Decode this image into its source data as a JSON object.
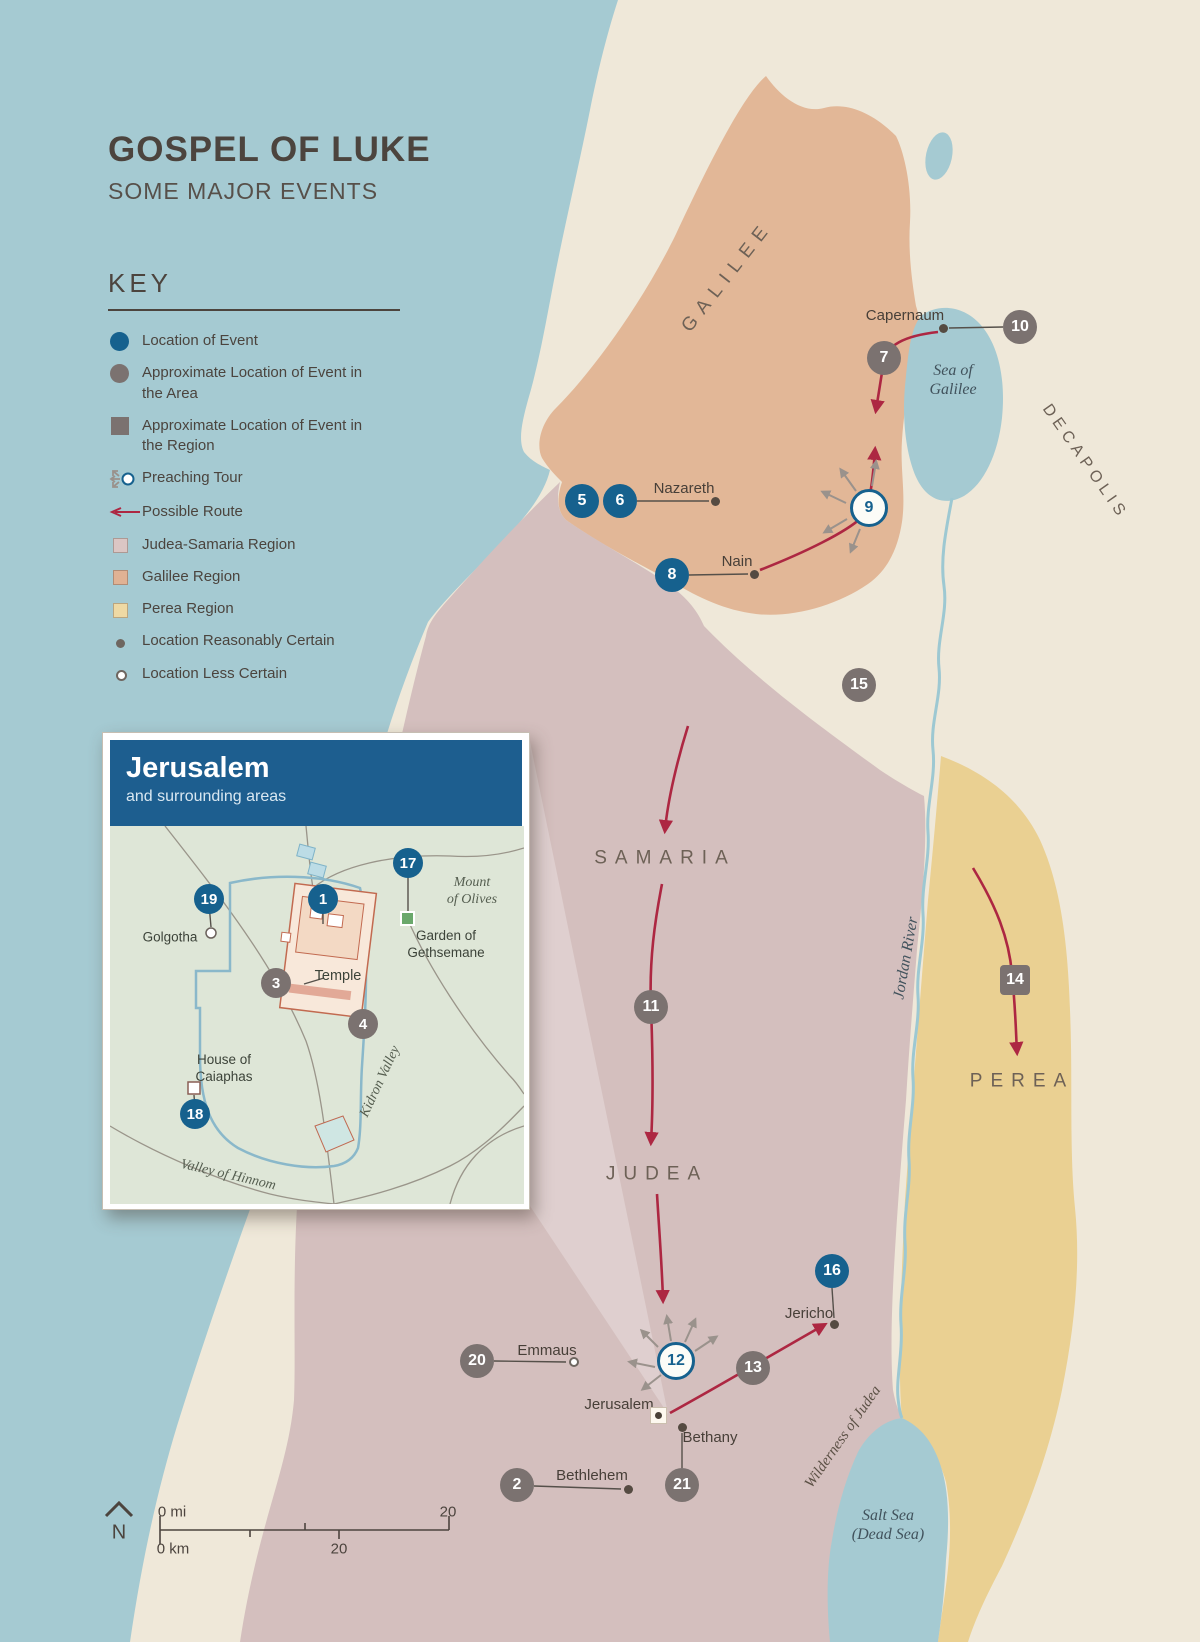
{
  "page": {
    "title": "GOSPEL OF LUKE",
    "subtitle": "SOME MAJOR EVENTS"
  },
  "key": {
    "heading": "KEY",
    "items": [
      {
        "icon": "event-circle-icon",
        "label": "Location of Event"
      },
      {
        "icon": "area-circle-icon",
        "label": "Approximate Location of Event in the Area"
      },
      {
        "icon": "region-square-icon",
        "label": "Approximate Location of Event in the Region"
      },
      {
        "icon": "preaching-tour-icon",
        "label": "Preaching Tour"
      },
      {
        "icon": "possible-route-icon",
        "label": "Possible Route"
      },
      {
        "icon": "judea-samaria-swatch-icon",
        "label": "Judea-Samaria Region"
      },
      {
        "icon": "galilee-swatch-icon",
        "label": "Galilee Region"
      },
      {
        "icon": "perea-swatch-icon",
        "label": "Perea Region"
      },
      {
        "icon": "certain-dot-icon",
        "label": "Location Reasonably Certain"
      },
      {
        "icon": "less-certain-dot-icon",
        "label": "Location Less Certain"
      }
    ]
  },
  "inset": {
    "title": "Jerusalem",
    "subtitle": "and surrounding areas",
    "labels": [
      {
        "text": "Golgotha",
        "cls": "inset-place",
        "x": 60,
        "y": 112
      },
      {
        "text": "Temple",
        "cls": "inset-place big",
        "x": 228,
        "y": 150
      },
      {
        "text": "House of\nCaiaphas",
        "cls": "inset-place",
        "x": 114,
        "y": 243
      },
      {
        "text": "Garden of\nGethsemane",
        "cls": "inset-place",
        "x": 336,
        "y": 119
      },
      {
        "text": "Mount\nof Olives",
        "cls": "inset-water",
        "x": 362,
        "y": 66
      },
      {
        "text": "Kidron Valley",
        "cls": "inset-water",
        "x": 271,
        "y": 256,
        "rotate": -65
      },
      {
        "text": "Valley of Hinnom",
        "cls": "inset-water",
        "x": 118,
        "y": 350,
        "rotate": 13
      }
    ],
    "markers": [
      {
        "n": "1",
        "type": "event",
        "x": 213,
        "y": 73
      },
      {
        "n": "3",
        "type": "area",
        "x": 166,
        "y": 157
      },
      {
        "n": "4",
        "type": "area",
        "x": 253,
        "y": 198
      },
      {
        "n": "17",
        "type": "event",
        "x": 298,
        "y": 37
      },
      {
        "n": "18",
        "type": "event",
        "x": 85,
        "y": 288
      },
      {
        "n": "19",
        "type": "event",
        "x": 99,
        "y": 73
      }
    ]
  },
  "map": {
    "labels": [
      {
        "text": "GALILEE",
        "cls": "region",
        "x": 728,
        "y": 277,
        "rotate": -52
      },
      {
        "text": "DECAPOLIS",
        "cls": "region small",
        "x": 1085,
        "y": 462,
        "rotate": 55
      },
      {
        "text": "SAMARIA",
        "cls": "region",
        "x": 665,
        "y": 859
      },
      {
        "text": "JUDEA",
        "cls": "region",
        "x": 657,
        "y": 1175
      },
      {
        "text": "PEREA",
        "cls": "region",
        "x": 1022,
        "y": 1082
      },
      {
        "text": "Sea of\nGalilee",
        "cls": "water",
        "x": 953,
        "y": 380
      },
      {
        "text": "Jordan River",
        "cls": "water",
        "x": 906,
        "y": 958,
        "rotate": -80
      },
      {
        "text": "Wilderness of Judea",
        "cls": "water dark",
        "x": 843,
        "y": 1437,
        "rotate": -55
      },
      {
        "text": "Salt Sea\n(Dead Sea)",
        "cls": "water",
        "x": 888,
        "y": 1525
      }
    ],
    "places": [
      {
        "name": "Capernaum",
        "x": 905,
        "y": 316
      },
      {
        "name": "Nazareth",
        "x": 684,
        "y": 489
      },
      {
        "name": "Nain",
        "x": 737,
        "y": 562
      },
      {
        "name": "Jericho",
        "x": 809,
        "y": 1314
      },
      {
        "name": "Emmaus",
        "x": 547,
        "y": 1351
      },
      {
        "name": "Jerusalem",
        "x": 619,
        "y": 1405
      },
      {
        "name": "Bethany",
        "x": 710,
        "y": 1438
      },
      {
        "name": "Bethlehem",
        "x": 592,
        "y": 1476
      }
    ],
    "dots": [
      {
        "kind": "filled",
        "x": 943,
        "y": 328
      },
      {
        "kind": "filled",
        "x": 715,
        "y": 501
      },
      {
        "kind": "filled",
        "x": 754,
        "y": 574
      },
      {
        "kind": "filled",
        "x": 834,
        "y": 1324
      },
      {
        "kind": "open",
        "x": 574,
        "y": 1362
      },
      {
        "kind": "square",
        "x": 659,
        "y": 1416
      },
      {
        "kind": "filled",
        "x": 682,
        "y": 1427
      },
      {
        "kind": "filled",
        "x": 628,
        "y": 1489
      }
    ],
    "markers": [
      {
        "n": "2",
        "type": "area",
        "x": 517,
        "y": 1485
      },
      {
        "n": "5",
        "type": "event",
        "x": 582,
        "y": 501
      },
      {
        "n": "6",
        "type": "event",
        "x": 620,
        "y": 501
      },
      {
        "n": "7",
        "type": "area",
        "x": 884,
        "y": 358
      },
      {
        "n": "8",
        "type": "event",
        "x": 672,
        "y": 575
      },
      {
        "n": "9",
        "type": "tour",
        "x": 869,
        "y": 508
      },
      {
        "n": "10",
        "type": "area",
        "x": 1020,
        "y": 327
      },
      {
        "n": "11",
        "type": "area",
        "x": 651,
        "y": 1007
      },
      {
        "n": "12",
        "type": "tour",
        "x": 676,
        "y": 1361
      },
      {
        "n": "13",
        "type": "area",
        "x": 753,
        "y": 1368
      },
      {
        "n": "14",
        "type": "region",
        "x": 1015,
        "y": 980
      },
      {
        "n": "15",
        "type": "area",
        "x": 859,
        "y": 685
      },
      {
        "n": "16",
        "type": "event",
        "x": 832,
        "y": 1271
      },
      {
        "n": "20",
        "type": "area",
        "x": 477,
        "y": 1361
      },
      {
        "n": "21",
        "type": "area",
        "x": 682,
        "y": 1485
      }
    ]
  },
  "scale": {
    "mi_start": "0 mi",
    "mi_end": "20",
    "km_start": "0 km",
    "km_end": "20",
    "north": "N"
  },
  "colors": {
    "sea": "#a5cad2",
    "land": "#efe8d9",
    "galilee_region": "#e2b797",
    "judea_samaria_region": "#d4bfbe",
    "perea_region": "#ead092",
    "marker_blue": "#16618e",
    "marker_gray": "#7b7270",
    "route_red": "#ad2742",
    "inset_header_blue": "#1d5e8f",
    "inset_ground_green": "#dee6d7"
  }
}
